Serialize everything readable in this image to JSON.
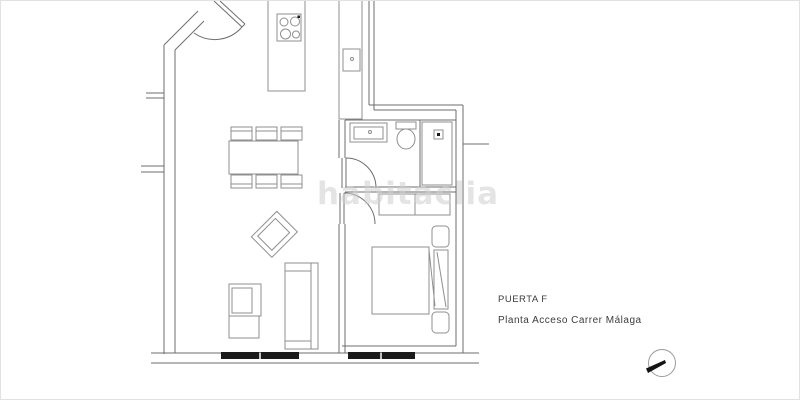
{
  "plan": {
    "watermark": "habitaclia",
    "unit_label": "PUERTA F",
    "floor_label": "Planta Acceso Carrer Málaga"
  },
  "icons": {
    "compass": "north-arrow-compass",
    "stove": "four-burner-stove",
    "kitchen_sink": "sink-with-faucet",
    "bathroom_sink": "vanity-sink",
    "toilet": "toilet",
    "shower_drain": "shower-drain"
  },
  "colors": {
    "background": "#ffffff",
    "border": "#e2e2e2",
    "wall": "#6e6e6e",
    "furniture": "#8f8f8f",
    "window": "#1b1b1b",
    "watermark": "#cfcfcf",
    "label": "#3c3c3c",
    "compass_ring": "#9a9a9a",
    "compass_needle": "#141414"
  }
}
